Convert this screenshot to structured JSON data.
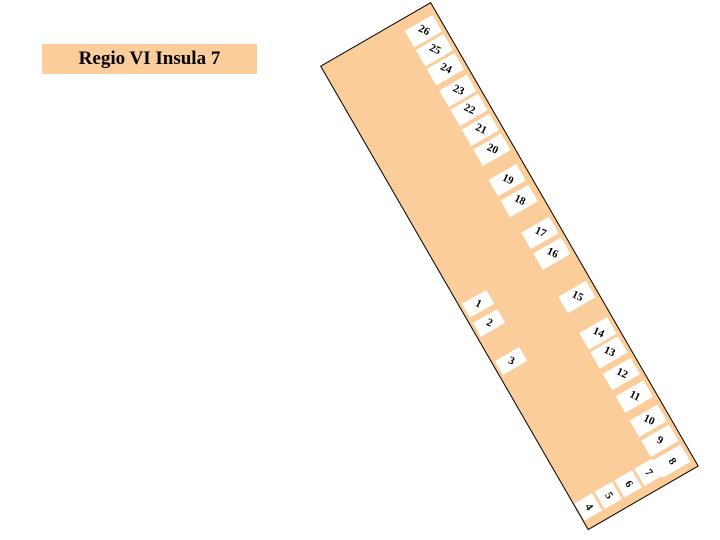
{
  "title": {
    "label": "Regio VI Insula 7"
  },
  "colors": {
    "insula_fill": "#FACD9B",
    "outline": "#000000",
    "entrance_fill": "#FFFFFF",
    "number_color": "#000000",
    "page_background": "#FFFFFF"
  },
  "insula": {
    "description": "Plan of city block with numbered doorways around perimeter",
    "entrances": [
      {
        "label": "1",
        "side": "west",
        "x": 3,
        "y": 276,
        "w": 28,
        "h": 16,
        "r": 55
      },
      {
        "label": "2",
        "side": "west",
        "x": 3,
        "y": 298,
        "w": 28,
        "h": 16,
        "r": 55
      },
      {
        "label": "3",
        "side": "west",
        "x": 3,
        "y": 342,
        "w": 28,
        "h": 16,
        "r": 55
      },
      {
        "label": "4",
        "side": "south",
        "x": 1,
        "y": 505,
        "w": 20,
        "h": 20,
        "r": 85
      },
      {
        "label": "5",
        "side": "south",
        "x": 24,
        "y": 505,
        "w": 20,
        "h": 20,
        "r": 85
      },
      {
        "label": "6",
        "side": "south",
        "x": 47,
        "y": 505,
        "w": 20,
        "h": 20,
        "r": 85
      },
      {
        "label": "7",
        "side": "south",
        "x": 70,
        "y": 505,
        "w": 20,
        "h": 20,
        "r": 85
      },
      {
        "label": "8",
        "side": "east",
        "x": 90,
        "y": 507,
        "w": 32,
        "h": 20,
        "r": 85
      },
      {
        "label": "9",
        "side": "east",
        "x": 90,
        "y": 484,
        "w": 32,
        "h": 19,
        "r": 55
      },
      {
        "label": "10",
        "side": "east",
        "x": 90,
        "y": 461,
        "w": 32,
        "h": 19,
        "r": 55
      },
      {
        "label": "11",
        "side": "east",
        "x": 90,
        "y": 433,
        "w": 32,
        "h": 19,
        "r": 55
      },
      {
        "label": "12",
        "side": "east",
        "x": 90,
        "y": 407,
        "w": 32,
        "h": 19,
        "r": 55
      },
      {
        "label": "13",
        "side": "east",
        "x": 90,
        "y": 382,
        "w": 32,
        "h": 19,
        "r": 55
      },
      {
        "label": "14",
        "side": "east",
        "x": 90,
        "y": 360,
        "w": 32,
        "h": 19,
        "r": 55
      },
      {
        "label": "15",
        "side": "east",
        "x": 90,
        "y": 318,
        "w": 32,
        "h": 19,
        "r": 55
      },
      {
        "label": "16",
        "side": "east",
        "x": 90,
        "y": 268,
        "w": 32,
        "h": 19,
        "r": 55
      },
      {
        "label": "17",
        "side": "east",
        "x": 90,
        "y": 244,
        "w": 32,
        "h": 19,
        "r": 55
      },
      {
        "label": "18",
        "side": "east",
        "x": 88,
        "y": 206,
        "w": 32,
        "h": 19,
        "r": 55
      },
      {
        "label": "19",
        "side": "east",
        "x": 88,
        "y": 182,
        "w": 32,
        "h": 19,
        "r": 55
      },
      {
        "label": "20",
        "side": "east",
        "x": 90,
        "y": 148,
        "w": 32,
        "h": 19,
        "r": 55
      },
      {
        "label": "21",
        "side": "east",
        "x": 90,
        "y": 125,
        "w": 32,
        "h": 19,
        "r": 55
      },
      {
        "label": "22",
        "side": "east",
        "x": 90,
        "y": 102,
        "w": 32,
        "h": 19,
        "r": 55
      },
      {
        "label": "23",
        "side": "east",
        "x": 90,
        "y": 80,
        "w": 32,
        "h": 19,
        "r": 55
      },
      {
        "label": "24",
        "side": "east",
        "x": 90,
        "y": 55,
        "w": 32,
        "h": 19,
        "r": 55
      },
      {
        "label": "25",
        "side": "east",
        "x": 90,
        "y": 33,
        "w": 32,
        "h": 19,
        "r": 55
      },
      {
        "label": "26",
        "side": "east",
        "x": 90,
        "y": 11,
        "w": 32,
        "h": 19,
        "r": 55
      }
    ]
  }
}
